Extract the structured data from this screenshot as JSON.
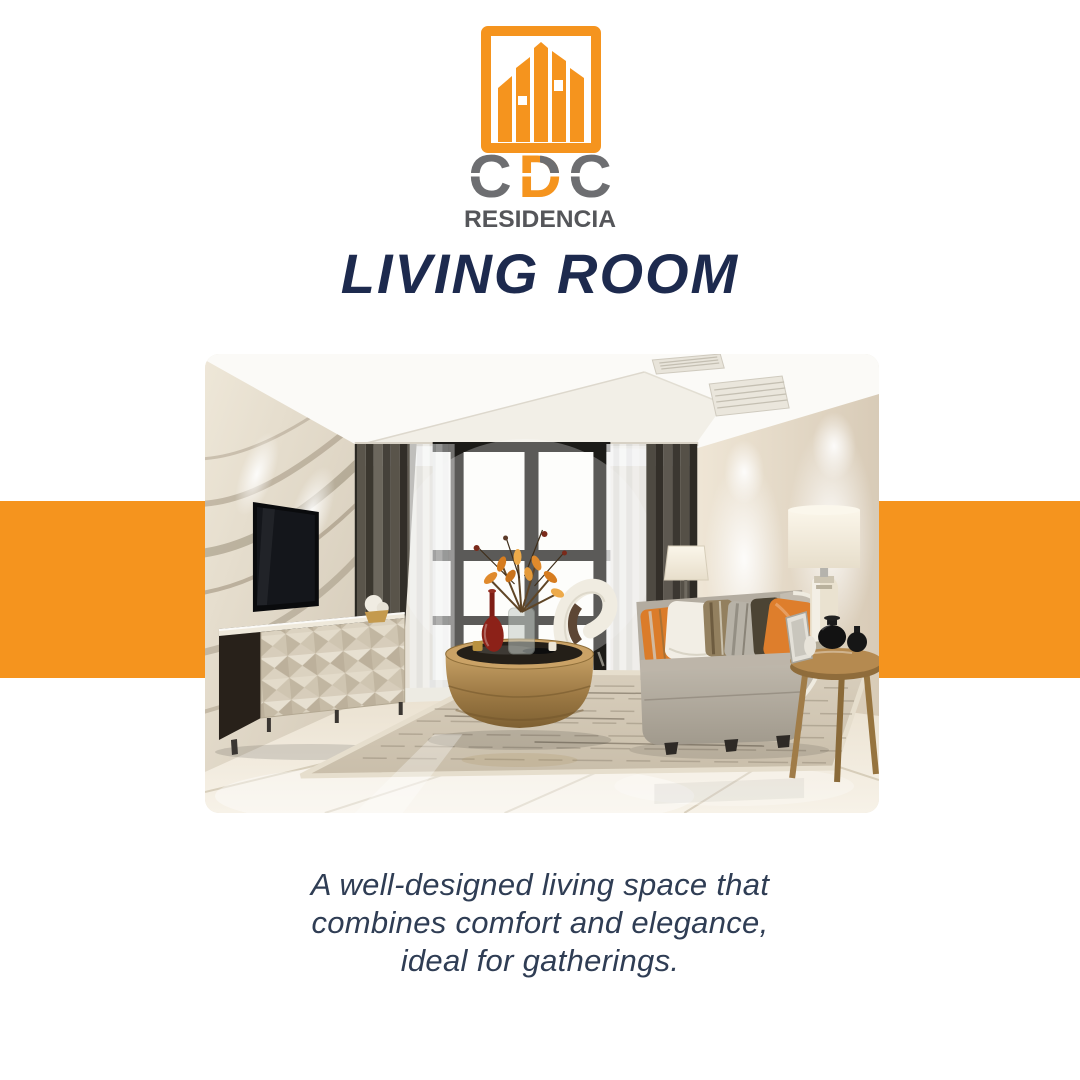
{
  "logo": {
    "letters": [
      {
        "char": "C",
        "color": "#6D6E71"
      },
      {
        "char": "D",
        "color": "#F5941E",
        "accent_piece_color": "#6D6E71"
      },
      {
        "char": "C",
        "color": "#6D6E71"
      }
    ],
    "wordmark": "RESIDENCIA",
    "wordmark_color": "#55565A",
    "frame_color": "#F5941E"
  },
  "title": {
    "text": "LIVING ROOM",
    "color": "#1D2A4E"
  },
  "accent_band": {
    "color": "#F5941E"
  },
  "description": {
    "color": "#2F3D54",
    "lines": [
      "A well-designed living space that",
      "combines comfort and elegance,",
      "ideal for gatherings."
    ]
  }
}
